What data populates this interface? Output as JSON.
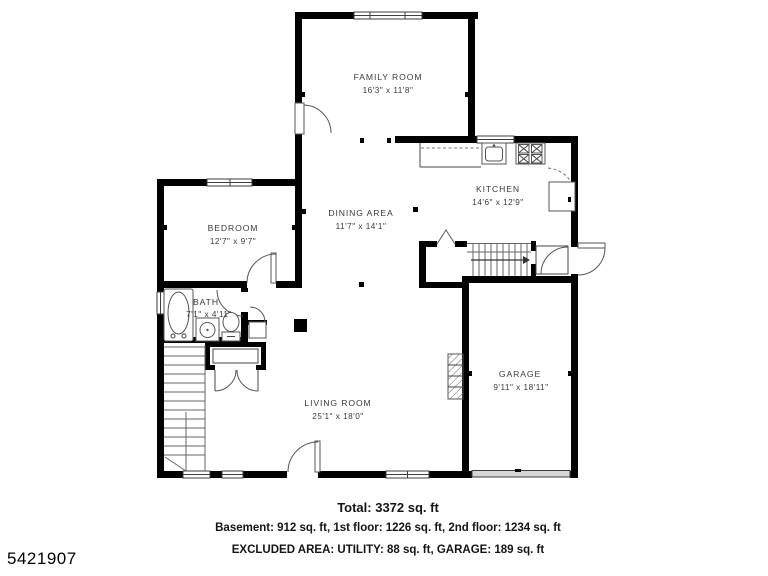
{
  "listing_id": "5421907",
  "plan": {
    "rooms": [
      {
        "name": "FAMILY ROOM",
        "dims": "16'3\" x 11'8\""
      },
      {
        "name": "KITCHEN",
        "dims": "14'6\" x 12'9\""
      },
      {
        "name": "BEDROOM",
        "dims": "12'7\" x 9'7\""
      },
      {
        "name": "DINING AREA",
        "dims": "11'7\" x 14'1\""
      },
      {
        "name": "BATH",
        "dims": "7'1\" x 4'11\""
      },
      {
        "name": "LIVING ROOM",
        "dims": "25'1\" x 18'0\""
      },
      {
        "name": "GARAGE",
        "dims": "9'11\" x 18'11\""
      }
    ]
  },
  "summary": {
    "total": "Total: 3372 sq. ft",
    "floors": "Basement: 912 sq. ft, 1st floor: 1226 sq. ft, 2nd floor: 1234 sq. ft",
    "excluded_area": "EXCLUDED AREA: UTILITY: 88 sq. ft, GARAGE: 189 sq. ft"
  },
  "colors": {
    "wall": "#000000",
    "label_text": "#3a3a3a",
    "garage_door_fill": "#d6d6d6",
    "background": "#ffffff"
  }
}
